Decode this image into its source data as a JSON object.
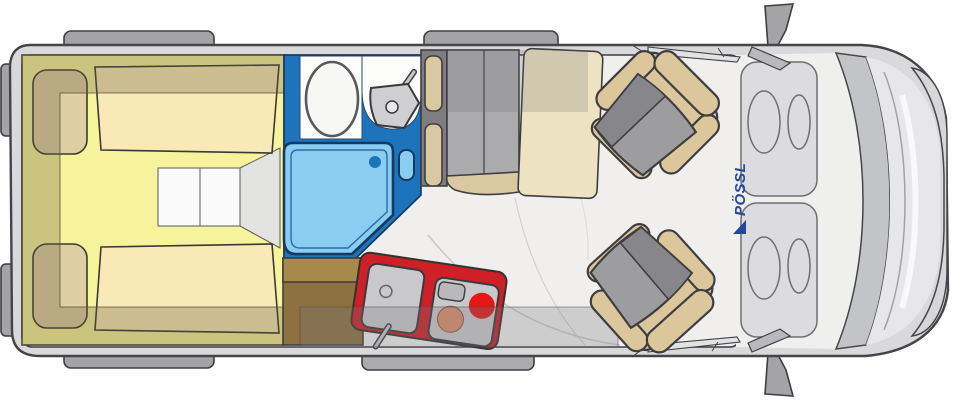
{
  "branding": {
    "logo_text": "PÖSSL",
    "logo_color": "#24469d"
  },
  "palette": {
    "body_gray": "#d9d9db",
    "floor": "#f0efed",
    "bump_gray": "#a4a4a7",
    "bed_yellow": "#f7f29c",
    "mattress_cream": "#f9e9b6",
    "pillow_tan": "#ddcea4",
    "overlay_khaki": "rgba(100,90,55,0.30)",
    "step_white": "#fafafa",
    "step_gray": "#e3e3e2",
    "bathroom_blue": "#1d74bd",
    "shower_blue": "#8bcdf0",
    "fixture_white": "#fcfcfb",
    "fixture_gray": "#cfcfd1",
    "kitchen_red": "#cf2027",
    "appliance_gray": "#c9c9cb",
    "burner_orange": "#dd8e6b",
    "burner_red": "#e41818",
    "cabinet_brown_light": "#a8894c",
    "cabinet_brown_dark": "#8d7140",
    "bench_back_gray": "#7e7e81",
    "bench_seat_gray": "#ababad",
    "cushion_beige": "#d9c8a0",
    "table_cream": "#ede3c2",
    "seat_beige": "#dcc79d",
    "seat_gray": "#9d9da0",
    "seat_gray_dark": "#87878b",
    "windshield_gray": "#c3c4c7",
    "hood_gray": "#e7e7e9",
    "bumper_gray": "#d7d7da",
    "dash_gray": "#dcdcdf",
    "door_overlay": "rgba(120,120,125,0.28)",
    "locker_overlay": "rgba(110,110,110,0.22)"
  }
}
